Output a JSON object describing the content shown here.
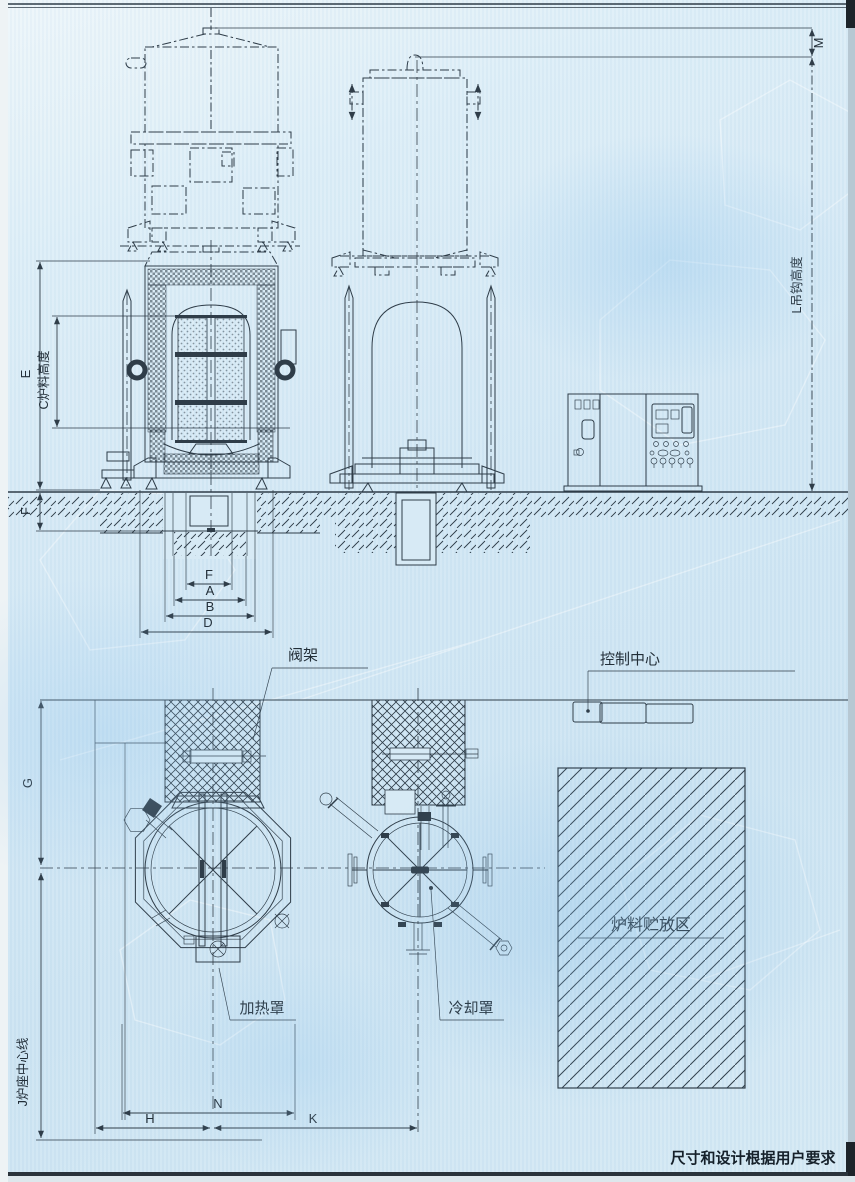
{
  "labels": {
    "valve_rack": "阀架",
    "control_center": "控制中心",
    "heating_cover": "加热罩",
    "cooling_cover": "冷却罩",
    "storage_area": "炉料贮放区",
    "base_centerline": "J炉座中心线",
    "hook_height": "L吊钩高度",
    "charge_height": "C炉料高度",
    "note": "尺寸和设计根据用户要求"
  },
  "dims": {
    "E": "E",
    "F_left": "F",
    "F_pit": "F",
    "A": "A",
    "B": "B",
    "D": "D",
    "M": "M",
    "G": "G",
    "H": "H",
    "N": "N",
    "K": "K"
  },
  "colors": {
    "paper": "#d7eaf5",
    "ink": "#2f3d49"
  }
}
